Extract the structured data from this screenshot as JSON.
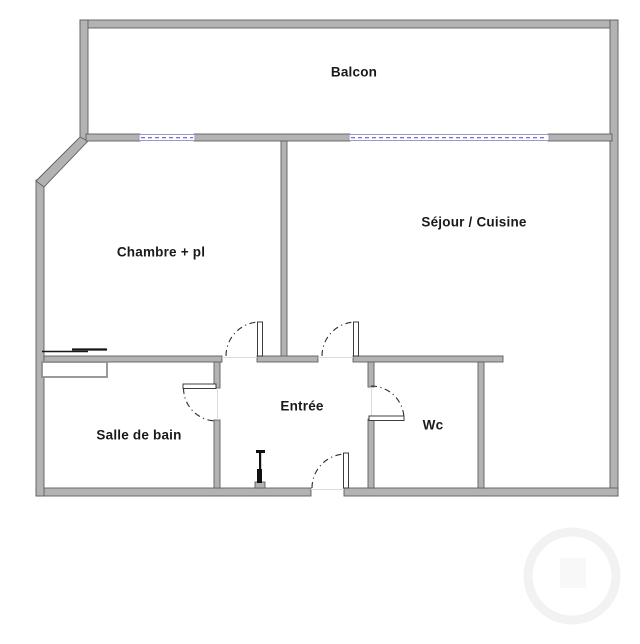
{
  "plan": {
    "type": "apartment-floor-plan",
    "rooms": [
      {
        "label": "Balcon"
      },
      {
        "label": "Séjour / Cuisine"
      },
      {
        "label": "Chambre + pl"
      },
      {
        "label": "Salle de bain"
      },
      {
        "label": "Entrée"
      },
      {
        "label": "Wc"
      }
    ],
    "features": {
      "windows": 2,
      "doors": 5
    },
    "colors": {
      "background": "#ffffff",
      "wall_fill": "#b3b3b3",
      "wall_edge": "#5f5f5f",
      "window_frame": "#9191c4",
      "window_glass": "#6f6fd8",
      "door_arc": "#2e2e2e",
      "label_text": "#1a1a1a"
    }
  }
}
